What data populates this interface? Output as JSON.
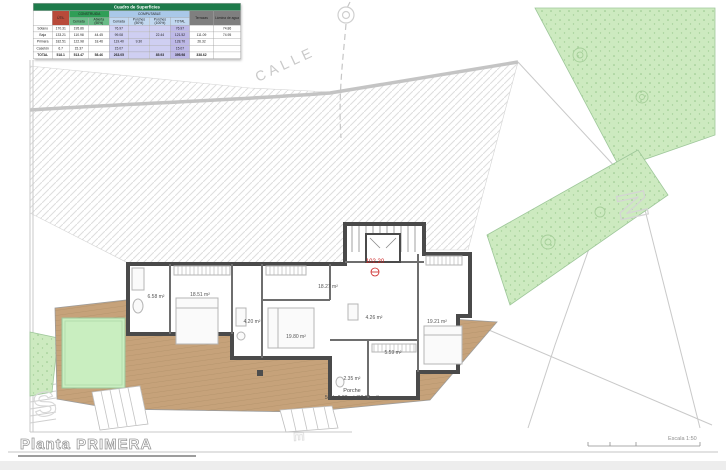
{
  "table": {
    "title": "Cuadro de Superficies",
    "groups": {
      "util": "ÚTIL",
      "construida": "CONSTRUIDA",
      "computable": "COMPUTABLE",
      "terrazas": "Terrazas",
      "lamina": "Lámina de agua"
    },
    "subheaders": {
      "cerrada": "Cerrada",
      "abierta": "Abierta (50%)",
      "comp_cerrada": "Cerrada",
      "porches50": "Porches (50%)",
      "porches100": "Porches (100%)",
      "total": "TOTAL"
    },
    "rows": [
      {
        "label": "Sótano",
        "util": "170.31",
        "cerrada": "195.86",
        "abierta": "",
        "comp_cerrada": "76.97",
        "porches50": "",
        "porches100": "",
        "total": "76.97",
        "terrazas": "",
        "lamina": "74.86"
      },
      {
        "label": "Baja",
        "util": "133.21",
        "cerrada": "110.98",
        "abierta": "44.45",
        "comp_cerrada": "99.08",
        "porches50": "",
        "porches100": "22.44",
        "total": "121.52",
        "terrazas": "111.09",
        "lamina": "74.95"
      },
      {
        "label": "Primera",
        "util": "182.51",
        "cerrada": "122.98",
        "abierta": "18.46",
        "comp_cerrada": "119.40",
        "porches50": "9.30",
        "porches100": "",
        "total": "128.70",
        "terrazas": "26.32",
        "lamina": ""
      },
      {
        "label": "Casetón",
        "util": "6.7",
        "cerrada": "15.37",
        "abierta": "",
        "comp_cerrada": "15.07",
        "porches50": "",
        "porches100": "",
        "total": "15.07",
        "terrazas": "",
        "lamina": ""
      },
      {
        "label": "TOTAL",
        "util": "518.1",
        "cerrada": "513.47",
        "abierta": "58.46",
        "comp_cerrada": "263.05",
        "porches50": "",
        "porches100": "85.93",
        "total": "395.98",
        "terrazas": "338.62",
        "lamina": ""
      }
    ]
  },
  "plan": {
    "street_label": "CALLE",
    "level_marker": "102.20",
    "rooms": [
      {
        "name": "bathroom-1",
        "area": "6.58 m²"
      },
      {
        "name": "bedroom-1",
        "area": "18.51 m²"
      },
      {
        "name": "bathroom-2",
        "area": "4.20 m²"
      },
      {
        "name": "bedroom-2",
        "area": "19.80 m²"
      },
      {
        "name": "hall",
        "area": "18.27 m²"
      },
      {
        "name": "bathroom-3",
        "area": "4.26 m²"
      },
      {
        "name": "bedroom-3",
        "area": "19.21 m²"
      },
      {
        "name": "dressing",
        "area": "5.59 m²"
      },
      {
        "name": "wc",
        "area": "2.35 m²"
      }
    ],
    "porch_label_line1": "Porche",
    "porch_label_line2": "50%=9.30 m² (18.60 m²)",
    "decor_letters": {
      "south": "S",
      "north": "N",
      "east": "E"
    }
  },
  "footer": {
    "title": "Planta PRIMERA",
    "scale_label": "Escala 1:50"
  },
  "colors": {
    "wall": "#4a4a4a",
    "deck": "#c6a27a",
    "green_area": "#cdeac0",
    "pool": "#c9eec0",
    "red_marker": "#cc2222",
    "table_title_bg": "#1e7b4b",
    "util_bg": "#b84a3a",
    "construida_bg": "#2f9e57",
    "computable_bg": "#a9c8e8"
  }
}
